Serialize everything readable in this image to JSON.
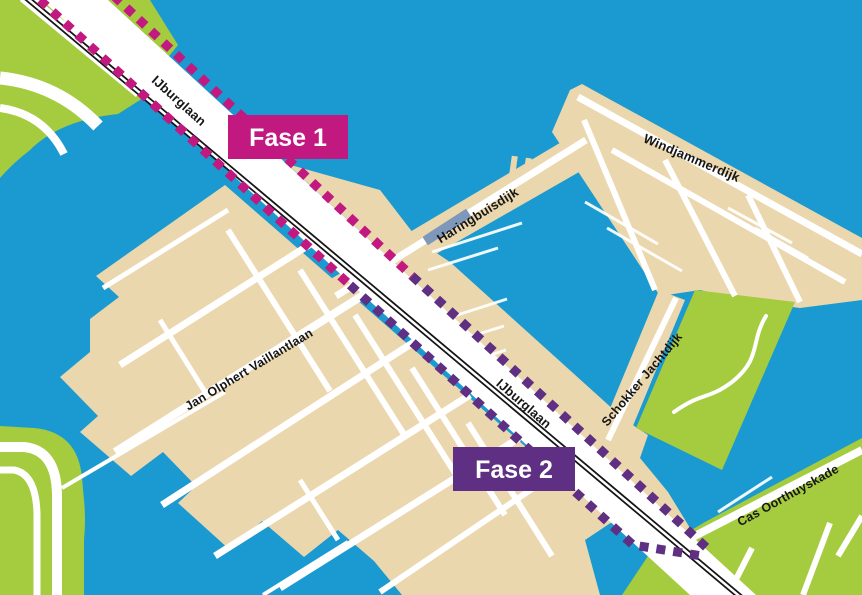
{
  "map": {
    "street_labels": {
      "ijburglaan_north": "IJburglaan",
      "ijburglaan_south": "IJburglaan",
      "haringbuisdijk": "Haringbuisdijk",
      "windjammerdijk": "Windjammerdijk",
      "jan_olphert_vaillantlaan": "Jan Olphert Vaillantlaan",
      "schokker_jachtdijk": "Schokker Jachtdijk",
      "cas_oorthuyskade": "Cas Oorthuyskade"
    },
    "phase_badges": {
      "fase1": "Fase 1",
      "fase2": "Fase 2"
    },
    "colors": {
      "water": "#1B9AD1",
      "land": "#EBD7AD",
      "park": "#A5CB3F",
      "road": "#FFFFFF",
      "rail": "#151515",
      "fase1": "#C21980",
      "fase2": "#5E2F82",
      "pier": "#7E98BC",
      "label": "#161616"
    }
  }
}
